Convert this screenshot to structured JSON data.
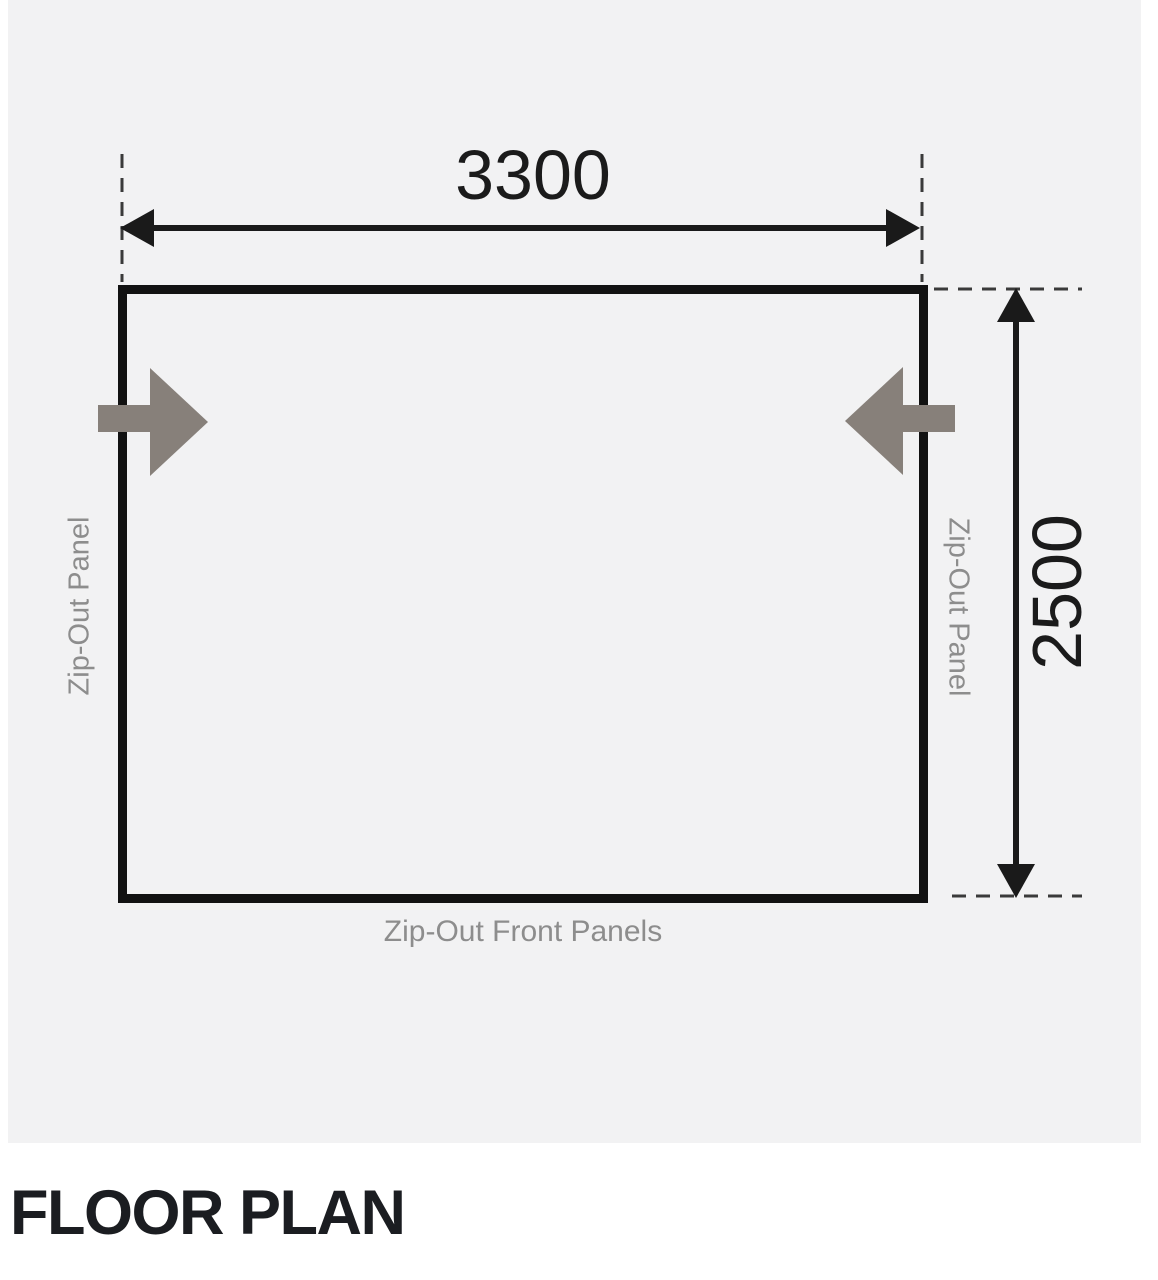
{
  "figure": {
    "width_dimension": "3300",
    "depth_dimension": "2500",
    "left_side_label": "Zip-Out Panel",
    "right_side_label": "Zip-Out Panel",
    "front_label": "Zip-Out Front Panels"
  },
  "caption": {
    "title": "FLOOR PLAN"
  },
  "icons": {
    "left_entrance": "arrow-right-icon",
    "right_entrance": "arrow-left-icon",
    "width_dimension": "double-headed-horizontal-arrow",
    "depth_dimension": "double-headed-vertical-arrow"
  },
  "colors": {
    "page_background": "#ffffff",
    "figure_background": "#f2f2f3",
    "floor_outline": "#121212",
    "dimension_lines": "#1a1a1a",
    "extension_lines": "#3a3a3a",
    "side_labels": "#8d8d8d",
    "entrance_arrows": "#87807a",
    "caption_text": "#1b1d21"
  }
}
